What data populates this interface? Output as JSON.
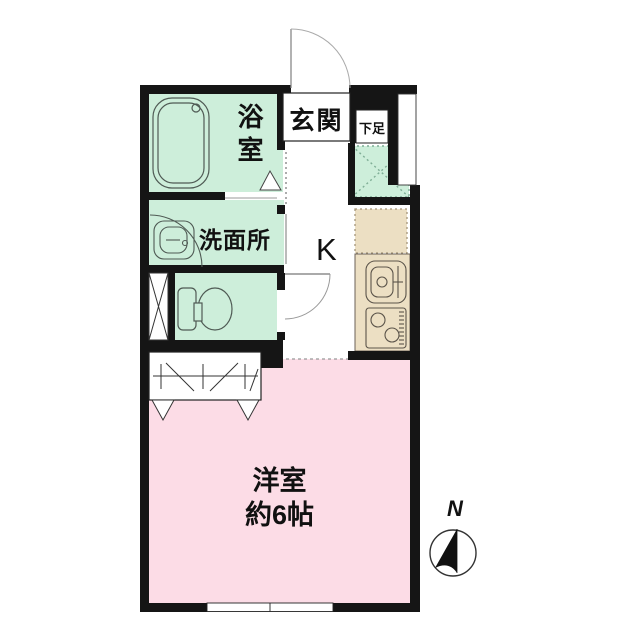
{
  "floorplan": {
    "type": "apartment-1K-floor-plan",
    "rooms": {
      "bathroom": {
        "label": "浴室"
      },
      "washroom": {
        "label": "洗面所"
      },
      "entrance": {
        "label": "玄関"
      },
      "shoe_storage": {
        "label": "下足"
      },
      "kitchen": {
        "label": "K"
      },
      "western_room": {
        "label": "洋室",
        "size": "約6帖"
      }
    },
    "compass": {
      "north_label": "N"
    },
    "fixtures": [
      "bathtub-icon",
      "washbasin-icon",
      "toilet-icon",
      "kitchen-sink-icon",
      "gas-stove-icon",
      "closet-hanger-icon",
      "washing-machine-space",
      "refrigerator-space",
      "pipe-space",
      "entrance-door-arc",
      "toilet-door-arc",
      "window",
      "compass-icon"
    ],
    "colors": {
      "wet_area_green": "#cdeeda",
      "room_pink": "#fcdce6",
      "kitchen_beige": "#ecdfc3",
      "wall_black": "#151515"
    }
  }
}
